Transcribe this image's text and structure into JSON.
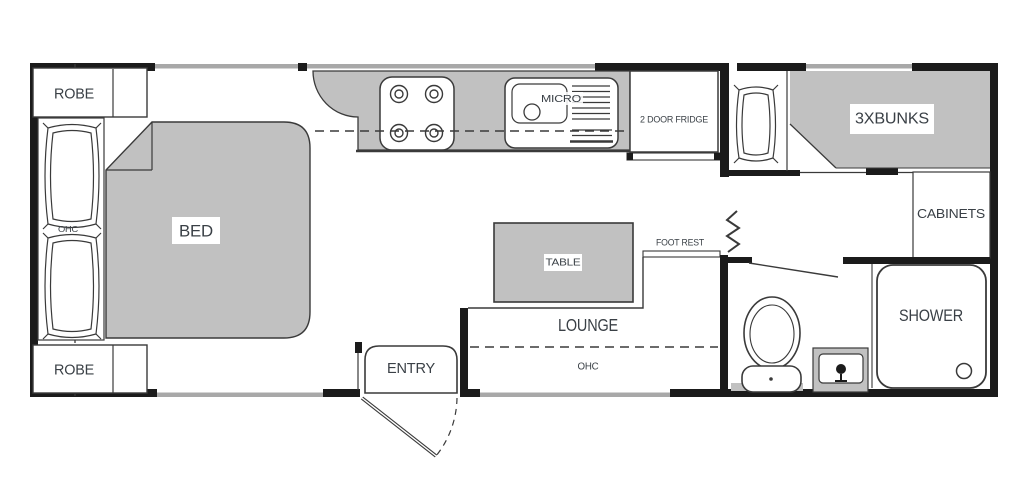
{
  "diagram_type": "caravan-floor-plan",
  "colors": {
    "wall": "#1b1b1b",
    "fill": "#c1c1c1",
    "line": "#3a3a3a",
    "window": "#a8a8a8",
    "text": "#3a4046",
    "background": "#ffffff"
  },
  "labels": {
    "robe_top": "ROBE",
    "robe_bottom": "ROBE",
    "bed": "BED",
    "bed_ohc": "OHC",
    "micro": "MICRO",
    "fridge": "2 DOOR FRIDGE",
    "bunks": "3XBUNKS",
    "cabinets": "CABINETS",
    "shower": "SHOWER",
    "table": "TABLE",
    "foot_rest": "FOOT REST",
    "lounge": "LOUNGE",
    "lounge_ohc": "OHC",
    "entry": "ENTRY"
  }
}
